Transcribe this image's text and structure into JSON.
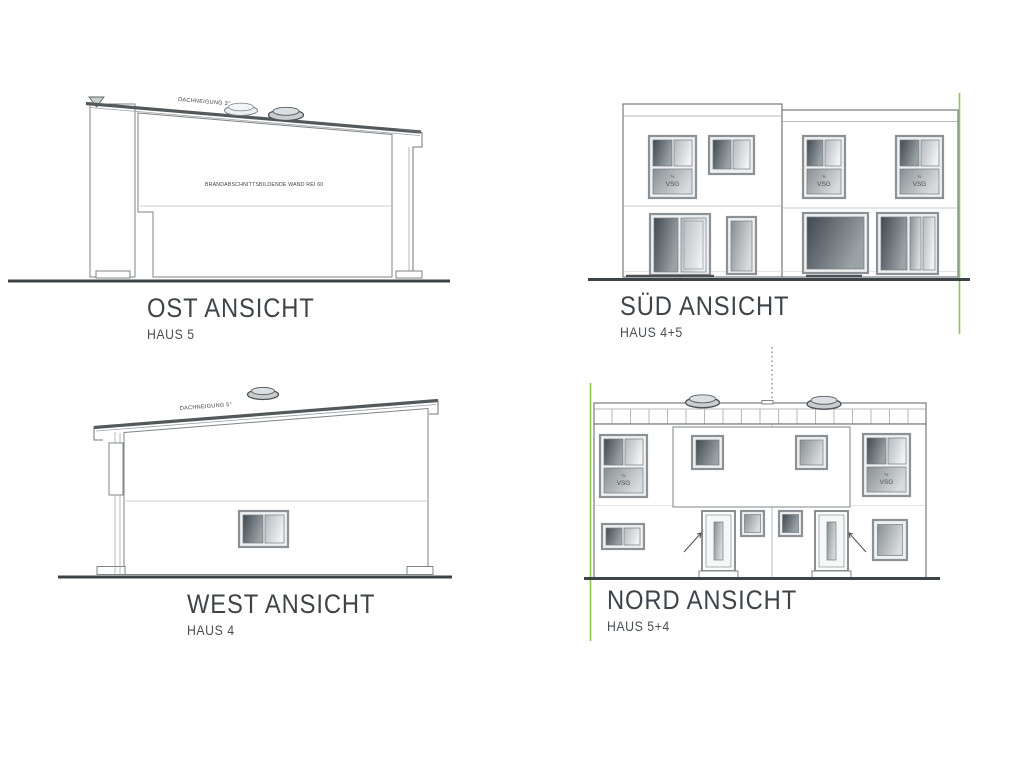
{
  "sheet": {
    "background": "#ffffff",
    "kind": "architectural elevation drawings"
  },
  "colors": {
    "ink": "#4c5357",
    "ground_line": "#3d4447",
    "boundary_green": "#8dc653",
    "glass_dark": "#434b51",
    "glass_light": "#eff1f2"
  },
  "labels": {
    "vsg": "VSG",
    "vsg_mark": "%"
  },
  "views": {
    "ost": {
      "title": "OST ANSICHT",
      "subtitle": "HAUS 5",
      "roof_note": "DACHNEIGUNG 3°",
      "wall_note": "BRANDABSCHNITTSBILDENDE WAND REI 60"
    },
    "sued": {
      "title": "SÜD ANSICHT",
      "subtitle": "HAUS 4+5"
    },
    "west": {
      "title": "WEST ANSICHT",
      "subtitle": "HAUS 4",
      "roof_note": "DACHNEIGUNG 5°"
    },
    "nord": {
      "title": "NORD ANSICHT",
      "subtitle": "HAUS 5+4"
    }
  }
}
